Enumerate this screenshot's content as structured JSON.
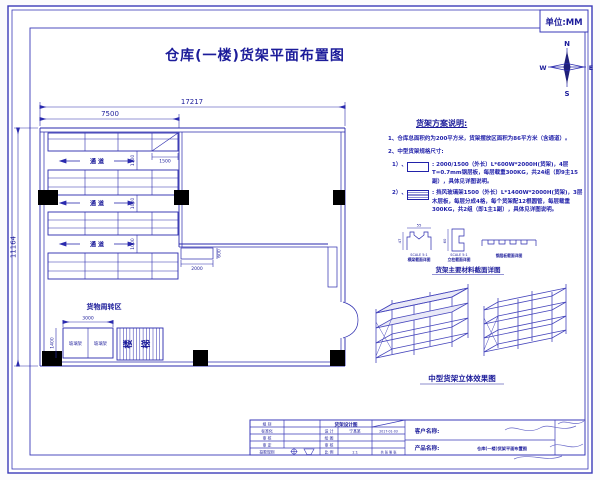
{
  "sheet": {
    "unit_label": "单位:MM",
    "title": "仓库(一楼)货架平面布置图",
    "compass": {
      "n": "N",
      "s": "S",
      "e": "E",
      "w": "W"
    }
  },
  "plan": {
    "dims": {
      "overall_width": "17217",
      "left_zone_width": "7500",
      "overall_depth": "11164",
      "corner_cell": "1500",
      "aisle1": "1100",
      "aisle2": "1000",
      "aisle3": "1000",
      "glass_width": "3000",
      "glass_depth": "1400",
      "inner_box_width": "2000",
      "inner_box_depth": "600"
    },
    "labels": {
      "aisle": "通 道",
      "turnover_area": "货物周转区",
      "glass_rack": "玻璃架",
      "stairs": [
        "楼",
        "梯"
      ]
    }
  },
  "notes": {
    "title": "货架方案说明:",
    "line1": "1、仓库总面积约为200平方米，货架摆放区面积为86平方米（含通道）。",
    "line2": "2、中型货架规格尺寸:",
    "item1_prefix": "1）、",
    "item1_text": ": 2000/1500（外长）L*600W*2000H(货架)，4层T=0.7mm钢层板，每层载重300KG，共24组（即9主15副），具体见详图说明。",
    "item2_prefix": "2）、",
    "item2_text": ": 挡风玻璃架1500（外长）L*1400W*2000H(货架)，3层木层板，每层分成4格，每个货架配12根圆管，每层载重300KG，共2组（即1主1副），具体见详图说明。"
  },
  "sections": {
    "beam_dim_w": "55",
    "beam_dim_h": "47",
    "col_dim_h": "60",
    "beam_scale": "SCALE 5:1",
    "beam_caption": "横梁截面详图",
    "col_scale": "SCALE 5:1",
    "col_caption": "立柱截面详图",
    "panel_caption": "钢层板截面详图",
    "main_caption": "货架主要材料截面详图"
  },
  "iso": {
    "caption": "中型货架立体效果图"
  },
  "titleblock": {
    "left_rows": [
      "组 别",
      "标准化",
      "审 核",
      "审 定",
      "投影规则"
    ],
    "center_header": "货架设计图",
    "design_label": "设 计",
    "designer": "宁某某",
    "date": "2017-01-03",
    "draw_label": "绘 图",
    "check_label": "审 核",
    "scale_label": "比 例",
    "scale_value": "1:1",
    "sheet_label": "共 张 第 张",
    "customer_label": "客户名称:",
    "product_label": "产品名称:",
    "product_value": "仓库(一楼)货架平面布置图"
  }
}
